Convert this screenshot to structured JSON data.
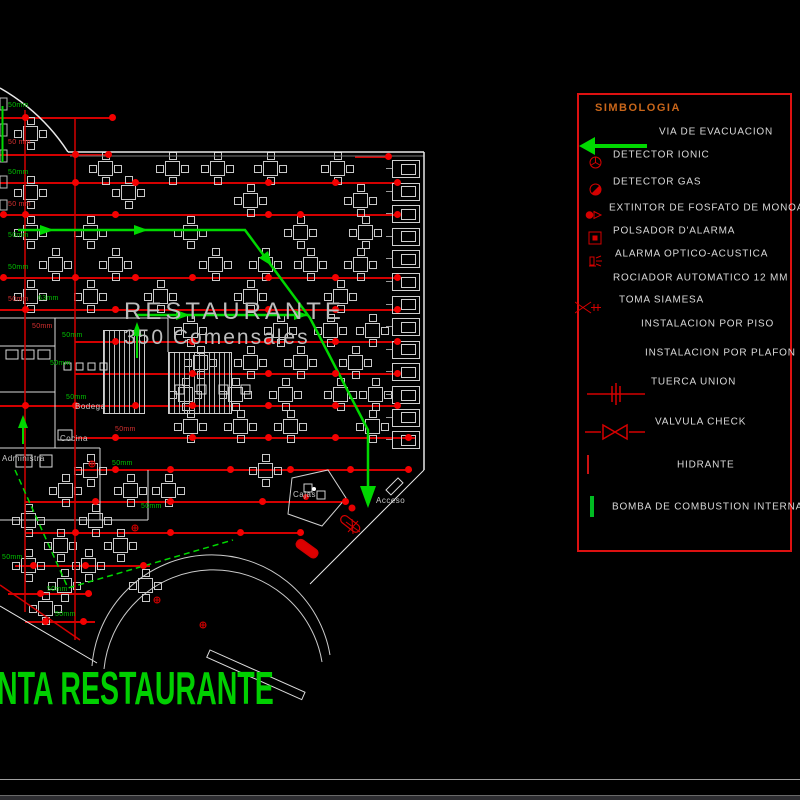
{
  "window": {
    "bottom_edge": true
  },
  "titles": {
    "plan_title": "NTA RESTAURANTE",
    "area_line1": "RESTAURANTE",
    "area_line2": "350 Comensales"
  },
  "colors": {
    "pipe_red": "#d40000",
    "dot_red": "#f40000",
    "evac_green": "#00d800",
    "label_green": "#00c400",
    "wall_white": "#e8e8e8",
    "cad_gray": "#c8c8c8",
    "legend_border_red": "#dd1111",
    "legend_title_orange": "#c9661a",
    "title_green": "#00cf00"
  },
  "plan": {
    "labels": [
      {
        "x": 8,
        "y": 106,
        "text": "50mm",
        "color": "g"
      },
      {
        "x": 8,
        "y": 143,
        "text": "50 mm",
        "color": "r"
      },
      {
        "x": 8,
        "y": 173,
        "text": "50mm",
        "color": "g"
      },
      {
        "x": 8,
        "y": 205,
        "text": "50 mm",
        "color": "r"
      },
      {
        "x": 8,
        "y": 236,
        "text": "50mm",
        "color": "g"
      },
      {
        "x": 8,
        "y": 268,
        "text": "50mm",
        "color": "g"
      },
      {
        "x": 8,
        "y": 300,
        "text": "50mm",
        "color": "r"
      },
      {
        "x": 38,
        "y": 299,
        "text": "63mm",
        "color": "g"
      },
      {
        "x": 32,
        "y": 327,
        "text": "50mm",
        "color": "r"
      },
      {
        "x": 62,
        "y": 336,
        "text": "50mm",
        "color": "g"
      },
      {
        "x": 50,
        "y": 364,
        "text": "50mm",
        "color": "g"
      },
      {
        "x": 66,
        "y": 398,
        "text": "50mm",
        "color": "g"
      },
      {
        "x": 115,
        "y": 430,
        "text": "50mm",
        "color": "r"
      },
      {
        "x": 112,
        "y": 464,
        "text": "50mm",
        "color": "g"
      },
      {
        "x": 141,
        "y": 507,
        "text": "50mm",
        "color": "g"
      },
      {
        "x": 2,
        "y": 558,
        "text": "50mm",
        "color": "g"
      },
      {
        "x": 47,
        "y": 590,
        "text": "50mm",
        "color": "g"
      },
      {
        "x": 55,
        "y": 615,
        "text": "50mm",
        "color": "g"
      },
      {
        "x": 75,
        "y": 406,
        "text": "Bodega",
        "color": "w"
      },
      {
        "x": 60,
        "y": 438,
        "text": "Cocina",
        "color": "w"
      },
      {
        "x": 2,
        "y": 458,
        "text": "Administra",
        "color": "w"
      },
      {
        "x": 293,
        "y": 494,
        "text": "Cajas",
        "color": "w"
      },
      {
        "x": 376,
        "y": 500,
        "text": "Acceso",
        "color": "w"
      }
    ],
    "tables": [
      [
        30,
        133
      ],
      [
        105,
        168
      ],
      [
        172,
        168
      ],
      [
        217,
        168
      ],
      [
        270,
        168
      ],
      [
        337,
        168
      ],
      [
        30,
        192
      ],
      [
        128,
        192
      ],
      [
        250,
        200
      ],
      [
        360,
        200
      ],
      [
        30,
        232
      ],
      [
        90,
        232
      ],
      [
        190,
        232
      ],
      [
        300,
        232
      ],
      [
        365,
        232
      ],
      [
        55,
        264
      ],
      [
        115,
        264
      ],
      [
        215,
        264
      ],
      [
        265,
        264
      ],
      [
        310,
        264
      ],
      [
        360,
        264
      ],
      [
        30,
        296
      ],
      [
        90,
        296
      ],
      [
        160,
        296
      ],
      [
        250,
        296
      ],
      [
        340,
        296
      ],
      [
        190,
        330
      ],
      [
        280,
        330
      ],
      [
        330,
        330
      ],
      [
        372,
        330
      ],
      [
        200,
        362
      ],
      [
        250,
        362
      ],
      [
        300,
        362
      ],
      [
        355,
        362
      ],
      [
        185,
        394
      ],
      [
        235,
        394
      ],
      [
        285,
        394
      ],
      [
        340,
        394
      ],
      [
        375,
        394
      ],
      [
        190,
        426
      ],
      [
        240,
        426
      ],
      [
        290,
        426
      ],
      [
        372,
        426
      ],
      [
        90,
        470
      ],
      [
        265,
        470
      ],
      [
        65,
        490
      ],
      [
        130,
        490
      ],
      [
        168,
        490
      ],
      [
        28,
        520
      ],
      [
        95,
        520
      ],
      [
        60,
        545
      ],
      [
        120,
        545
      ],
      [
        28,
        565
      ],
      [
        88,
        565
      ],
      [
        64,
        585
      ],
      [
        145,
        585
      ],
      [
        45,
        608
      ]
    ],
    "pipes": [
      {
        "y": 118,
        "x1": 0,
        "x2": 112,
        "dots": [
          25,
          112
        ]
      },
      {
        "y": 155,
        "x1": 0,
        "x2": 108,
        "dots": [
          75,
          108
        ]
      },
      {
        "y": 157,
        "x1": 355,
        "x2": 390,
        "dots": [
          388
        ]
      },
      {
        "y": 183,
        "x1": 0,
        "x2": 400,
        "dots": [
          75,
          135,
          268,
          335,
          397
        ]
      },
      {
        "y": 215,
        "x1": 0,
        "x2": 400,
        "dots": [
          3,
          25,
          115,
          268,
          300,
          397
        ]
      },
      {
        "y": 278,
        "x1": 0,
        "x2": 400,
        "dots": [
          3,
          75,
          135,
          192,
          268,
          335,
          397
        ]
      },
      {
        "y": 310,
        "x1": 0,
        "x2": 400,
        "dots": [
          25,
          115,
          268,
          335,
          397
        ]
      },
      {
        "y": 342,
        "x1": 75,
        "x2": 400,
        "dots": [
          115,
          192,
          268,
          335,
          397
        ]
      },
      {
        "y": 374,
        "x1": 75,
        "x2": 400,
        "dots": [
          192,
          268,
          335,
          397
        ]
      },
      {
        "y": 406,
        "x1": 0,
        "x2": 400,
        "dots": [
          25,
          75,
          135,
          192,
          268,
          335,
          397
        ]
      },
      {
        "y": 438,
        "x1": 75,
        "x2": 415,
        "dots": [
          115,
          192,
          268,
          335,
          408
        ]
      },
      {
        "y": 470,
        "x1": 75,
        "x2": 412,
        "dots": [
          115,
          170,
          230,
          290,
          350,
          408
        ]
      },
      {
        "y": 502,
        "x1": 25,
        "x2": 345,
        "dots": [
          95,
          170,
          262,
          345
        ]
      },
      {
        "y": 533,
        "x1": 25,
        "x2": 300,
        "dots": [
          75,
          170,
          240,
          300
        ]
      },
      {
        "y": 566,
        "x1": 15,
        "x2": 150,
        "dots": [
          33,
          85,
          143
        ]
      },
      {
        "y": 594,
        "x1": 8,
        "x2": 92,
        "dots": [
          40,
          88
        ]
      },
      {
        "y": 622,
        "x1": 25,
        "x2": 95,
        "dots": [
          45,
          83
        ]
      }
    ],
    "booths": {
      "x": 392,
      "y_start": 160,
      "count": 13,
      "step": 22.6
    }
  },
  "legend": {
    "title": "SIMBOLOGIA",
    "items": [
      {
        "id": "evac",
        "label": "VIA DE EVACUACION",
        "y": 37,
        "label_x": 80
      },
      {
        "id": "ionic",
        "label": "DETECTOR IONIC",
        "y": 60,
        "label_x": 34
      },
      {
        "id": "gas",
        "label": "DETECTOR GAS",
        "y": 87,
        "label_x": 34
      },
      {
        "id": "extintor",
        "label": "EXTINTOR DE FOSFATO DE MONOAM",
        "y": 113,
        "label_x": 30
      },
      {
        "id": "polsador",
        "label": "POLSADOR D'ALARMA",
        "y": 136,
        "label_x": 34
      },
      {
        "id": "alarma",
        "label": "ALARMA OPTICO-ACUSTICA",
        "y": 159,
        "label_x": 36
      },
      {
        "id": "rociador",
        "label": "ROCIADOR AUTOMATICO 12 MM",
        "y": 183,
        "label_x": 34
      },
      {
        "id": "siamesa",
        "label": "TOMA SIAMESA",
        "y": 205,
        "label_x": 40
      },
      {
        "id": "piso",
        "label": "INSTALACION POR PISO",
        "y": 229,
        "label_x": 62
      },
      {
        "id": "plafon",
        "label": "INSTALACION POR PLAFON",
        "y": 258,
        "label_x": 66
      },
      {
        "id": "tuerca",
        "label": "TUERCA UNION",
        "y": 287,
        "label_x": 72
      },
      {
        "id": "valvula",
        "label": "VALVULA CHECK",
        "y": 327,
        "label_x": 76
      },
      {
        "id": "hidrante",
        "label": "HIDRANTE",
        "y": 370,
        "label_x": 98
      },
      {
        "id": "bomba",
        "label": "BOMBA DE COMBUSTION INTERNA",
        "y": 412,
        "label_x": 33
      }
    ]
  }
}
